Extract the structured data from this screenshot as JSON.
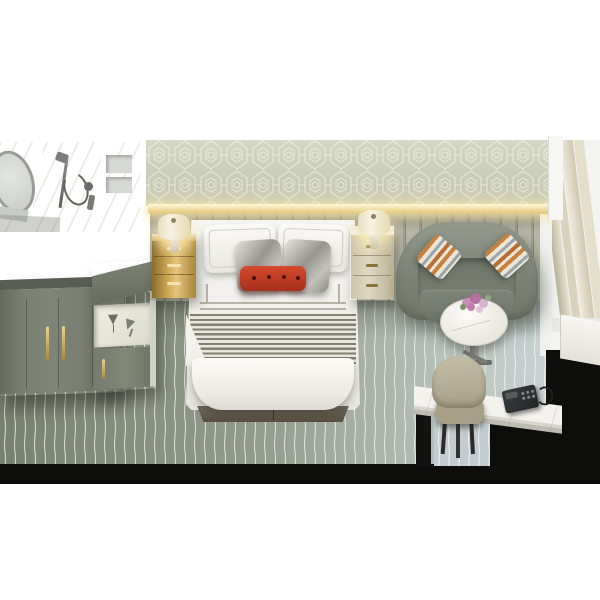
{
  "image": {
    "description": "Isometric cutaway 3D rendering of a hotel guest room viewed from above on a plain white background; no text, menus or UI controls are present",
    "render_style": "photorealistic architectural visualization"
  },
  "room": {
    "back_wall": "sage wallpaper with white geometric hexagon lattice pattern and warm LED cove light above a channel-tufted headboard",
    "floor": "sage-grey carpet with thin wavy white pinstripes",
    "cutaway_edge": "solid black floor slab edge along the bottom and right of the scene"
  },
  "areas": [
    {
      "name": "bathroom-vignette",
      "position": "top-left",
      "items": [
        "oval framed mirror",
        "handheld shower set on chrome rail",
        "recessed marble niche shelves"
      ],
      "finish": "white-grey marble tile"
    },
    {
      "name": "sleeping-area",
      "position": "center",
      "items": [
        "king bed",
        "two brass and marble nightstands",
        "two lit drum-shade lamps"
      ]
    },
    {
      "name": "lounge-area",
      "position": "right",
      "items": [
        "curved sage loveseat",
        "round white marble side table with pink flowers"
      ]
    },
    {
      "name": "work-area",
      "position": "bottom-right",
      "items": [
        "white marble desk with black legs",
        "beige upholstered chair",
        "black telephone"
      ]
    },
    {
      "name": "storage-area",
      "position": "left",
      "items": [
        "sage wardrobe with brass pulls",
        "minibar cabinet with glassware niche"
      ]
    },
    {
      "name": "window-wall",
      "position": "far-right",
      "items": [
        "champagne drapery panels"
      ]
    }
  ],
  "bedding": [
    "white duvet with stitched border",
    "two white euro pillows with embroidered rim",
    "two silver satin accent pillows",
    "red button-tufted lumbar pillow",
    "grey striped throw blanket at foot of bed"
  ],
  "palette": {
    "background": "#ffffff",
    "carpet_dark": "#79816f",
    "carpet_light": "#cdd6d8",
    "carpet_stripe": "#f5f7f2",
    "wallpaper": "#c9cdb9",
    "headboard": "#a9a897",
    "led_glow": "#ffe9a8",
    "brass": "#caa752",
    "sofa": "#7d8478",
    "red_pillow": "#c2402a",
    "blanket_stripe": "#837f72",
    "floor_cut_black": "#0d0d0c",
    "curtain": "#d8d2bc",
    "chair": "#b7af97",
    "phone": "#2e3132",
    "flowers": "#c18bb0",
    "marble": "#f2f1ec"
  }
}
